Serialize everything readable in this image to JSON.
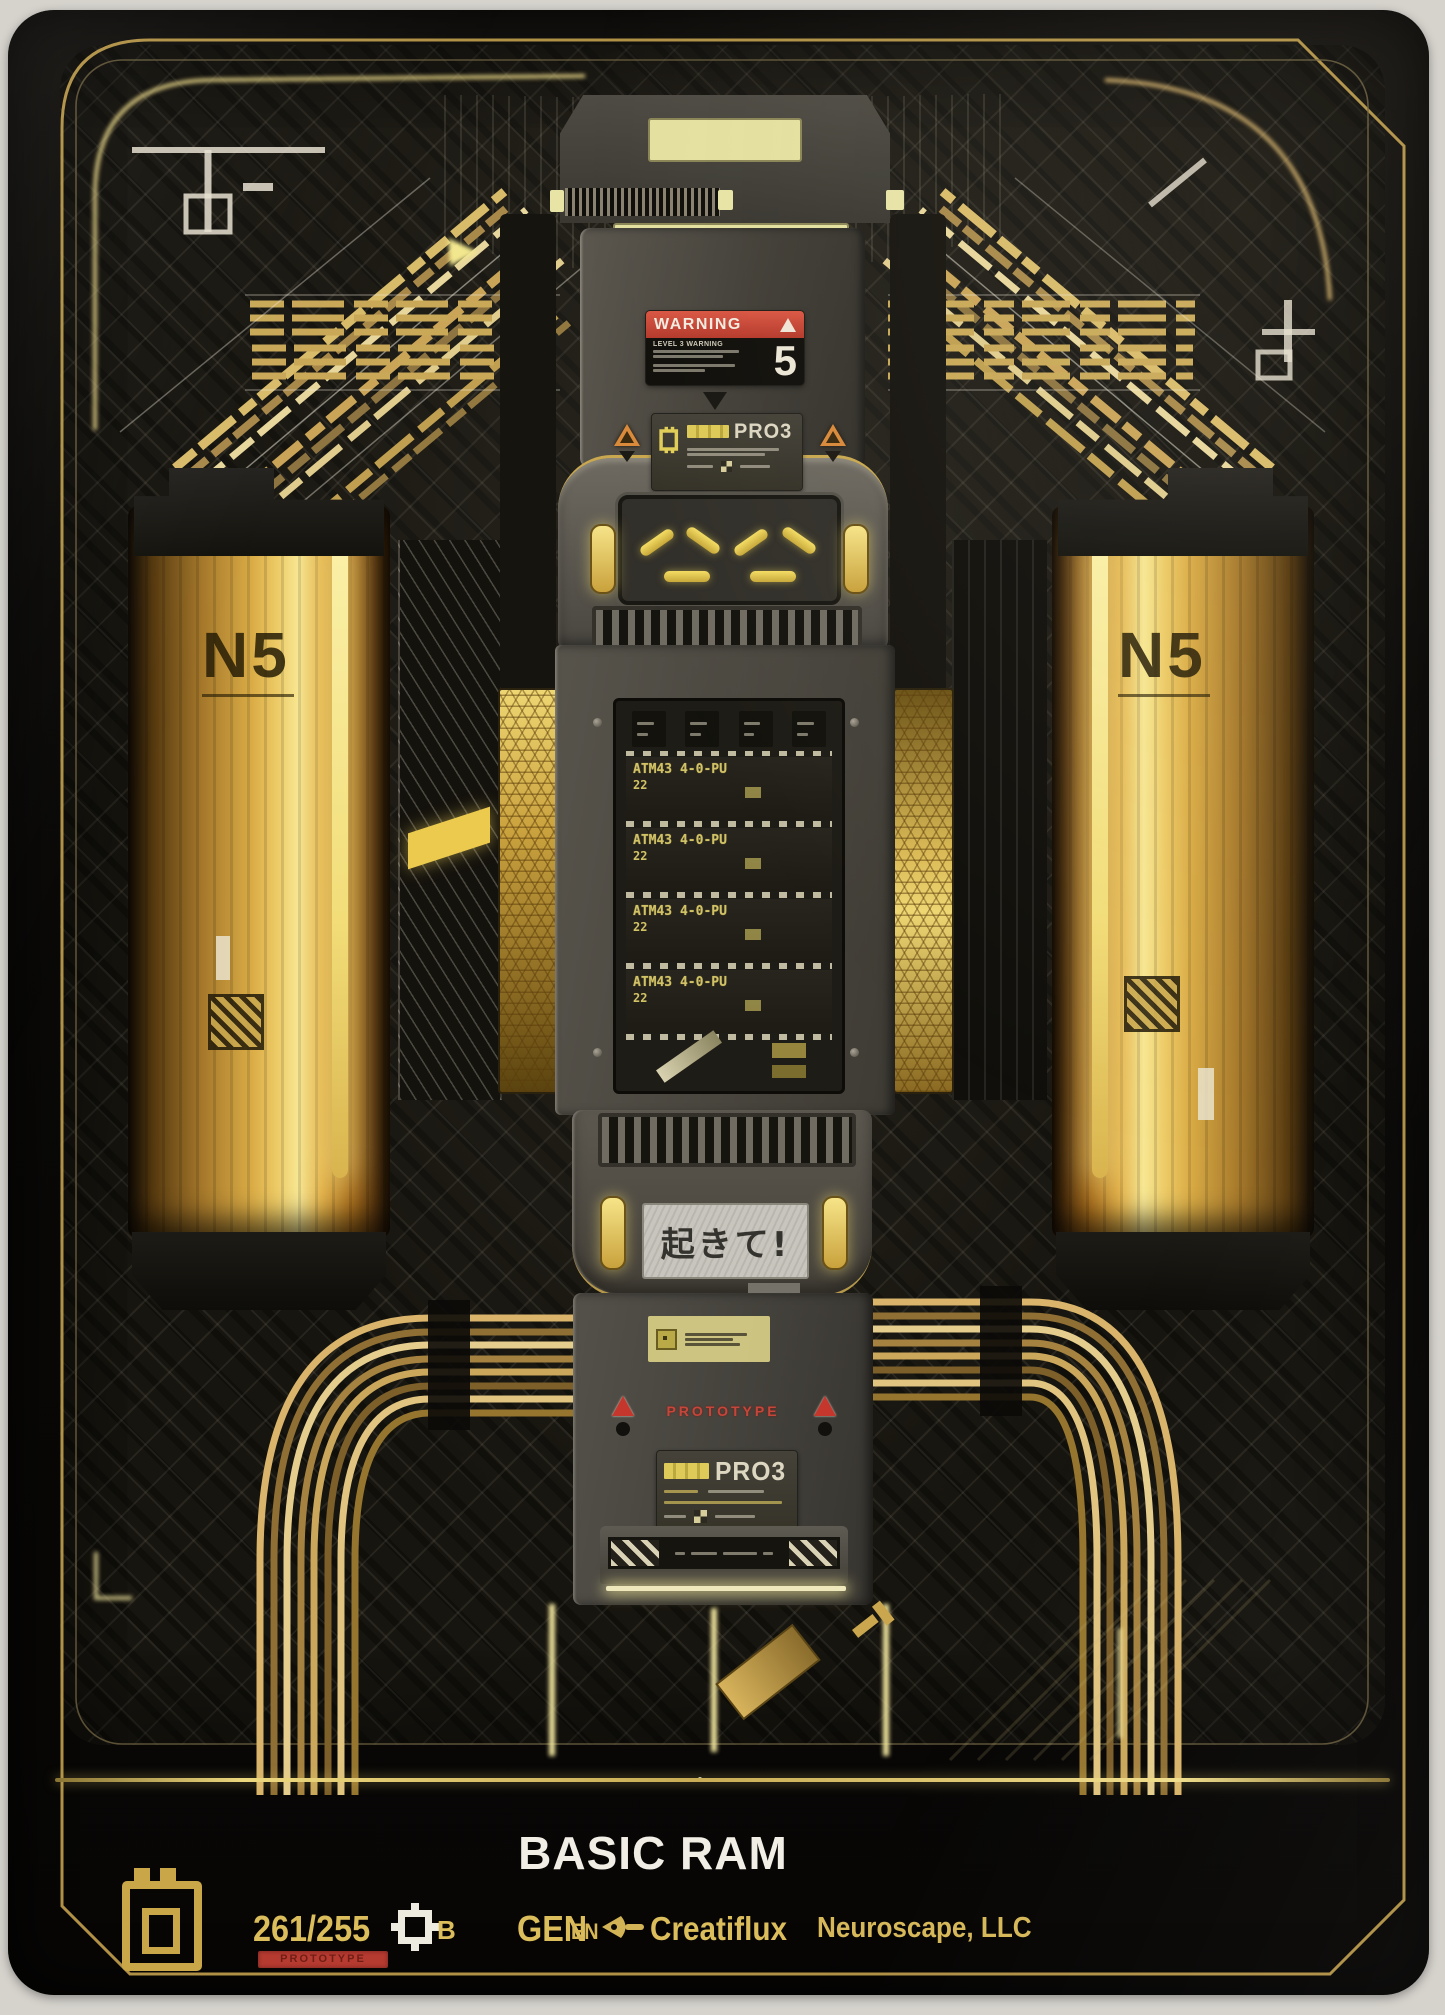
{
  "footer": {
    "title": "BASIC RAM",
    "collector_number": "261/255",
    "rarity": "B",
    "prototype_badge": "PROTOTYPE",
    "gen_label": "GEN",
    "language": "EN",
    "studio": "Creatiflux",
    "publisher": "Neuroscape, LLC"
  },
  "artwork": {
    "warning_label": {
      "header": "WARNING",
      "level_line": "LEVEL 3 WARNING",
      "level_number": "5"
    },
    "module_top_label": {
      "model": "PRO3"
    },
    "module_bottom_label": {
      "model": "PRO3"
    },
    "prototype_stamp": "PROTOTYPE",
    "wake_screen_text": "起きて!",
    "left_cylinder_logo": "N5",
    "right_cylinder_logo": "N5",
    "ram_chips": [
      {
        "part": "ATM43 4-0-PU",
        "size": "22"
      },
      {
        "part": "ATM43 4-0-PU",
        "size": "22"
      },
      {
        "part": "ATM43 4-0-PU",
        "size": "22"
      },
      {
        "part": "ATM43 4-0-PU",
        "size": "22"
      }
    ]
  },
  "colors": {
    "gold_accent": "#dcbd5c",
    "glow_yellow": "#f5e27a",
    "warning_red": "#cf4a3a",
    "prototype_red": "#b53a30",
    "module_gray": "#55524c",
    "card_black": "#0c0b09",
    "photo_background": "#d6d3cd"
  }
}
